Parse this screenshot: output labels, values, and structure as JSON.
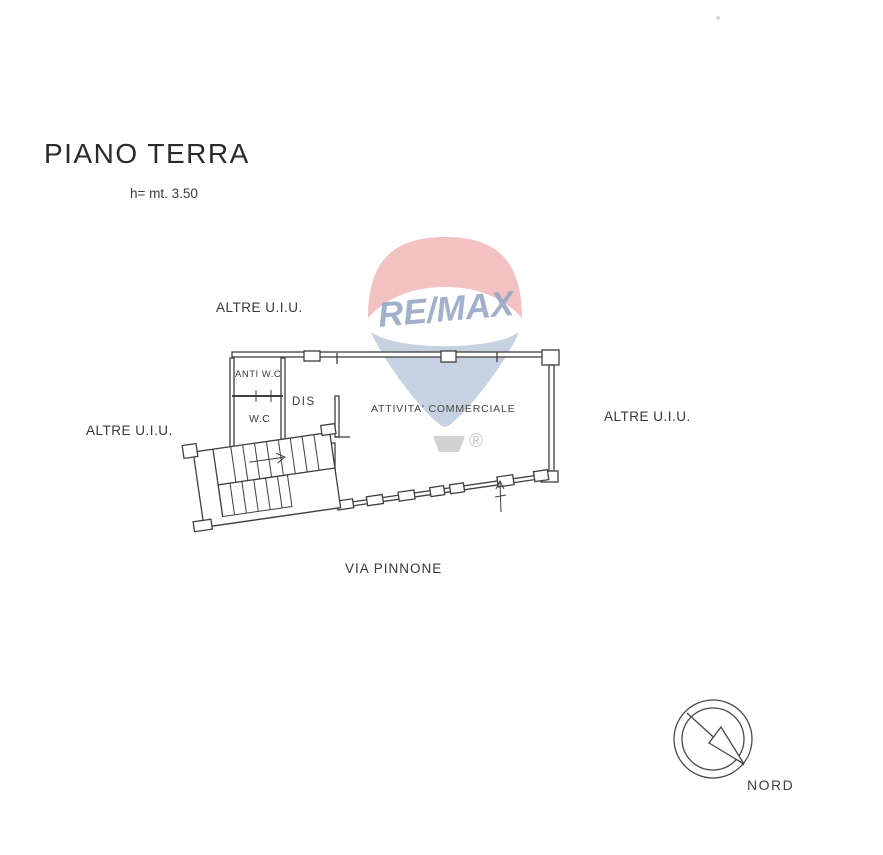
{
  "document": {
    "title": "PIANO TERRA",
    "height_note": "h= mt. 3.50"
  },
  "plan": {
    "rooms": {
      "anti_wc": "ANTI W.C",
      "wc": "W.C",
      "dis": "DIS",
      "commercial": "ATTIVITA' COMMERCIALE"
    },
    "adjacent_units": {
      "top": "ALTRE U.I.U.",
      "left": "ALTRE U.I.U.",
      "right": "ALTRE U.I.U."
    },
    "street": "VIA PINNONE"
  },
  "compass": {
    "label": "NORD"
  },
  "watermark": {
    "brand": "RE/MAX",
    "registered": "®",
    "colors": {
      "canopy_red": "#f0b4b4",
      "canopy_blue": "#b9c7db",
      "text_blue": "#91a3c3",
      "basket_gray": "#c7c7ca"
    }
  },
  "style": {
    "line_color": "#3f3f3f",
    "background": "#ffffff"
  }
}
